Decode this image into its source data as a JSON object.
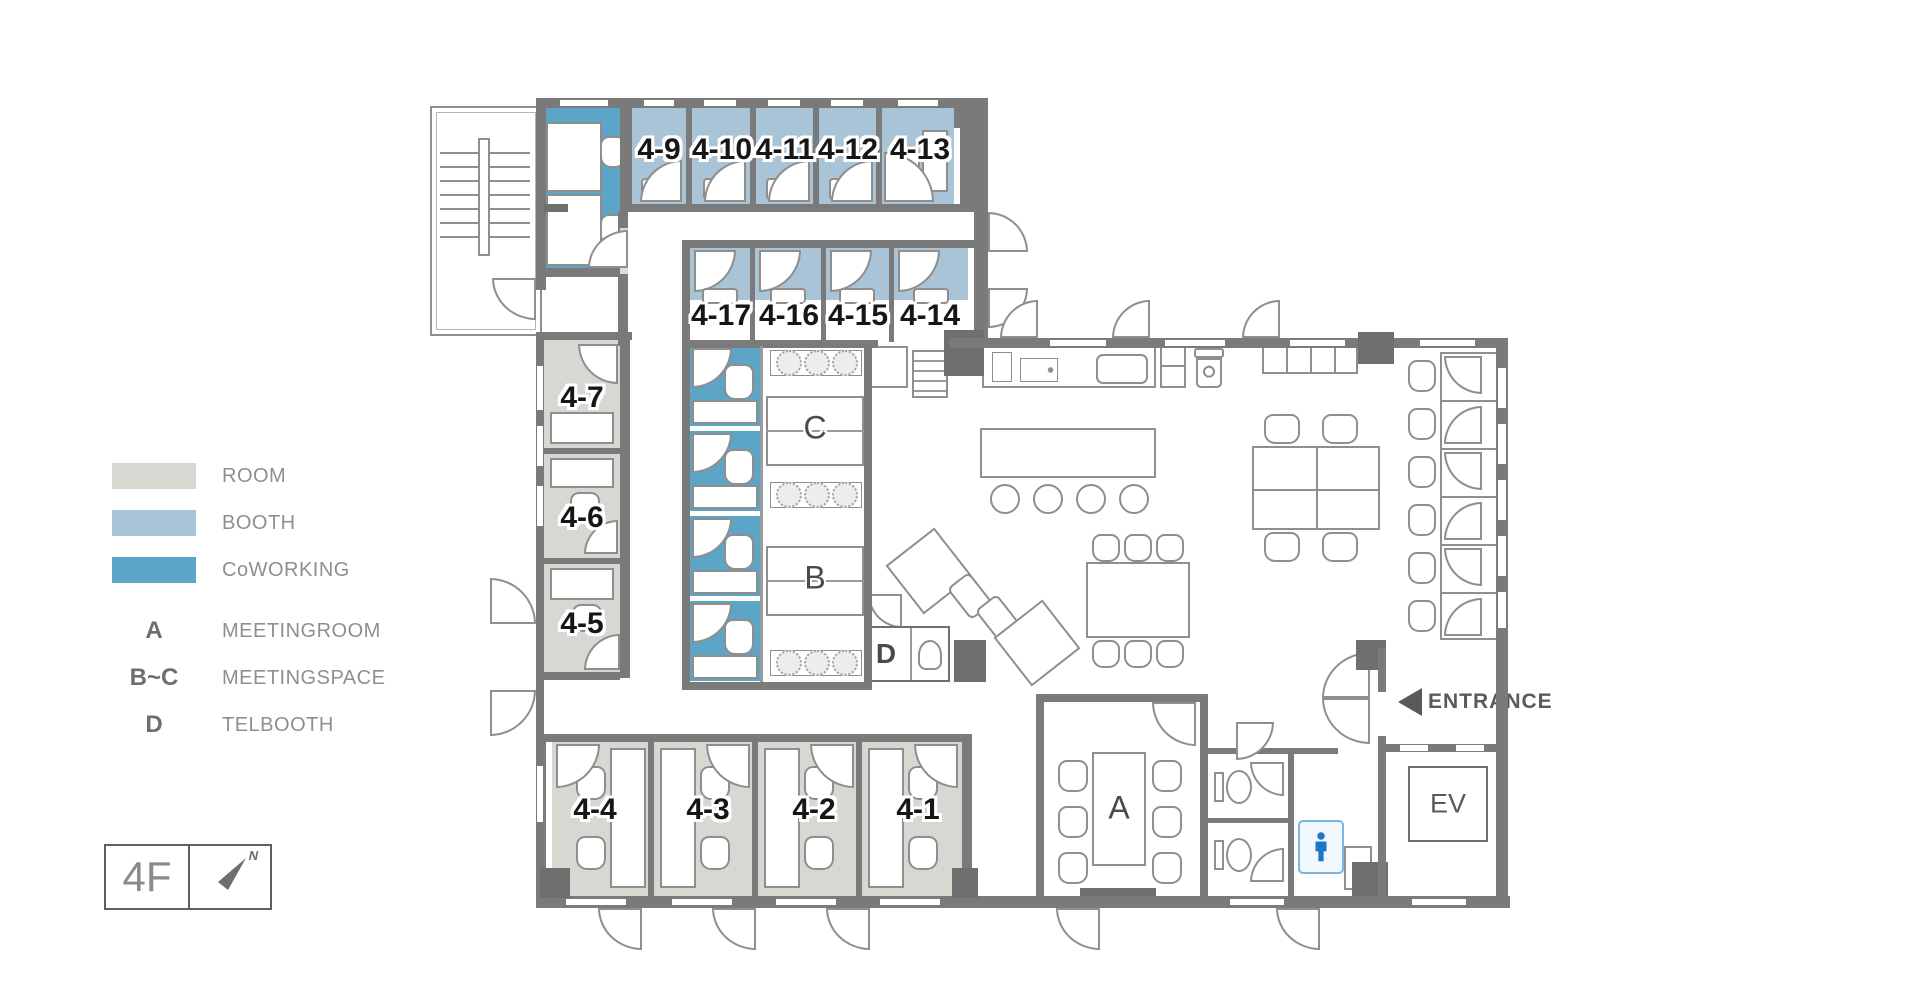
{
  "floor": {
    "label": "4F",
    "north_label": "N"
  },
  "legend": {
    "swatches": [
      {
        "label": "ROOM",
        "color": "#d7d8d2"
      },
      {
        "label": "BOOTH",
        "color": "#a9c4d6"
      },
      {
        "label": "CoWORKING",
        "color": "#5da5c6"
      }
    ],
    "keys": [
      {
        "key": "A",
        "label": "MEETINGROOM"
      },
      {
        "key": "B~C",
        "label": "MEETINGSPACE"
      },
      {
        "key": "D",
        "label": "TELBOOTH"
      }
    ]
  },
  "rooms": {
    "top_row": [
      "4-9",
      "4-10",
      "4-11",
      "4-12",
      "4-13"
    ],
    "second_row": [
      "4-17",
      "4-16",
      "4-15",
      "4-14"
    ],
    "left_column": [
      "4-7",
      "4-6",
      "4-5"
    ],
    "bottom_row": [
      "4-4",
      "4-3",
      "4-2",
      "4-1"
    ]
  },
  "areas": {
    "meeting_room": "A",
    "meeting_space_c": "C",
    "meeting_space_b": "B",
    "telbooth": "D",
    "elevator": "EV",
    "entrance": "ENTRANCE"
  },
  "colors": {
    "wall": "#7a7a7a",
    "room_fill": "#d7d8d2",
    "booth_fill": "#a9c4d6",
    "coworking_fill": "#5da5c6",
    "restroom_icon_blue": "#1c78c4"
  }
}
